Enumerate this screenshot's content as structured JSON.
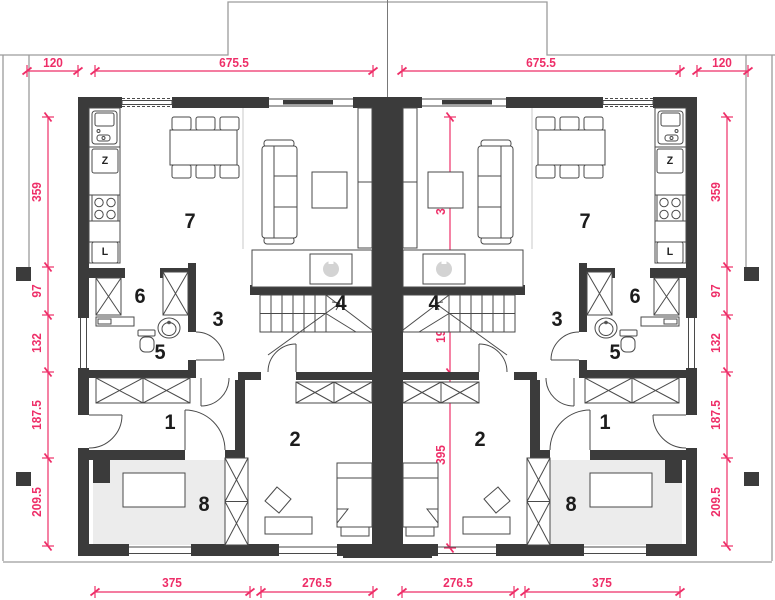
{
  "dims": {
    "top": [
      "120",
      "675.5",
      "675.5",
      "120"
    ],
    "bottom": [
      "375",
      "276.5",
      "276.5",
      "375"
    ],
    "side": [
      "359",
      "97",
      "132",
      "187.5",
      "209.5"
    ],
    "inner": [
      "395",
      "191",
      "395"
    ]
  },
  "rooms": {
    "entry_hall": "1",
    "bedroom": "2",
    "corridor": "3",
    "staircase": "4",
    "wc": "5",
    "pantry": "6",
    "living_kitchen": "7",
    "garage": "8"
  },
  "appliances": {
    "dishwasher": "Z",
    "fridge": "L"
  },
  "colors": {
    "dimension": "#ee2e68",
    "wall": "#3b3b3b",
    "outline": "#9c9c9c",
    "axis": "#787878",
    "garage_floor": "#ececec",
    "furniture_stroke": "#4a4a4a"
  }
}
